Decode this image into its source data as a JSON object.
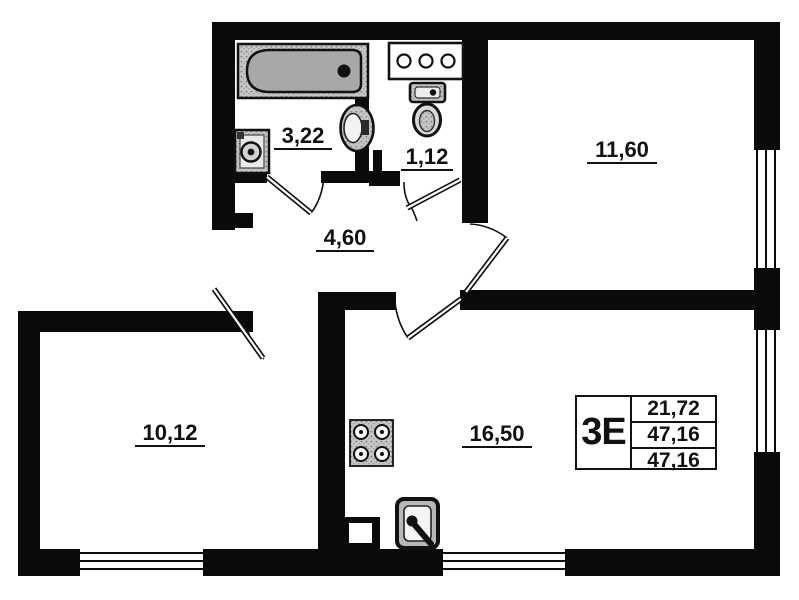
{
  "plan_title": "apartment floor plan",
  "rooms": [
    {
      "id": "bathroom",
      "label": "3,22"
    },
    {
      "id": "wc",
      "label": "1,12"
    },
    {
      "id": "bedroom",
      "label": "11,60"
    },
    {
      "id": "hallway",
      "label": "4,60"
    },
    {
      "id": "room",
      "label": "10,12"
    },
    {
      "id": "kitchen_living",
      "label": "16,50"
    }
  ],
  "info_box": {
    "type_label": "3Е",
    "values": [
      "21,72",
      "47,16",
      "47,16"
    ]
  },
  "fixtures": [
    "bathtub",
    "washing-machine",
    "pedestal-sink",
    "toilet",
    "riser-shaft",
    "stove",
    "kitchen-sink"
  ],
  "colors": {
    "wall": "#0a0a0a",
    "fixture_gray": "#c9c9c9",
    "background": "#ffffff"
  }
}
